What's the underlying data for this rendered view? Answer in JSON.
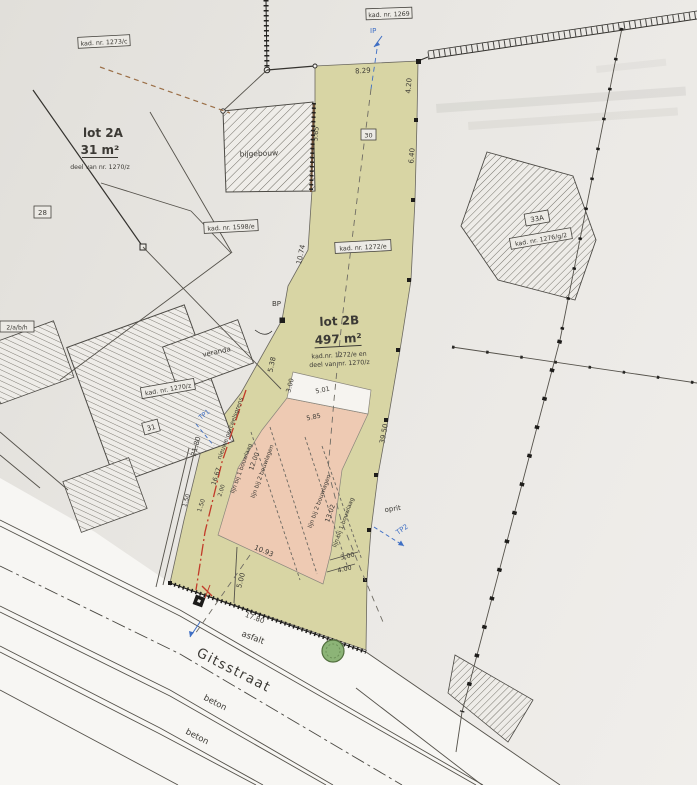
{
  "plan": {
    "lot2a": {
      "title": "lot 2A",
      "area": "31 m²",
      "note": "deel van nr. 1270/z"
    },
    "lot2b": {
      "title": "lot 2B",
      "area": "497 m²",
      "note1": "kad.nr. 1272/e en",
      "note2": "deel van nr. 1270/z"
    },
    "kad_labels": {
      "l1273": "kad. nr. 1273/c",
      "l1269": "kad. nr. 1269",
      "l1598": "kad. nr. 1598/e",
      "l1272": "kad. nr. 1272/e",
      "l1276": "kad. nr. 1276/g/2",
      "l1270": "kad. nr. 1270/z",
      "edge_partial": "2/a/b/h"
    },
    "house_numbers": {
      "n28": "28",
      "n30": "30",
      "n31": "31",
      "n33a": "33A"
    },
    "buildings": {
      "bijgebouw": "bijgebouw",
      "veranda": "veranda"
    },
    "street": {
      "name": "Gitsstraat",
      "asfalt": "asfalt",
      "beton_upper": "beton",
      "beton_lower": "beton",
      "oprit": "oprit"
    },
    "survey_points": {
      "bp": "BP",
      "ip": "IP",
      "tp1": "TP1",
      "tp2": "TP2"
    },
    "build_lines": {
      "one_a": "lijn bij 1 bouwlaag",
      "two_a": "lijn bij 2 bouwlagen",
      "two_b": "lijn bij 2 bouwlagen",
      "one_b": "lijn bij 1 bouwlaag",
      "red_boundary": "nieuwe perceelsgrens"
    },
    "dims": {
      "d829": "8.29",
      "d420": "4.20",
      "d640": "6.40",
      "d565": "5.65",
      "d1074": "10.74",
      "d538": "5.38",
      "d3950": "39.50",
      "d2180": "21.80",
      "d1667": "16.67",
      "d200": "2.00",
      "d150a": "1.50",
      "d150b": "1.50",
      "d1200": "12.00",
      "d300a": "3.00",
      "d501": "5.01",
      "d585": "5.85",
      "d1302": "13.02",
      "d300b": "3.00",
      "d400": "4.00",
      "d1093": "10.93",
      "d500": "5.00",
      "d1780": "17.80"
    }
  },
  "colors": {
    "parcel_green": "#d8d5a4",
    "building_zone_pink": "#eecab3",
    "boundary_red": "#c23b2a",
    "marker_blue": "#3f6fc4",
    "paper": "#e9e7e3",
    "road_white": "#f7f6f3",
    "tree_green": "#8cb477",
    "ink": "#3c3a35"
  }
}
